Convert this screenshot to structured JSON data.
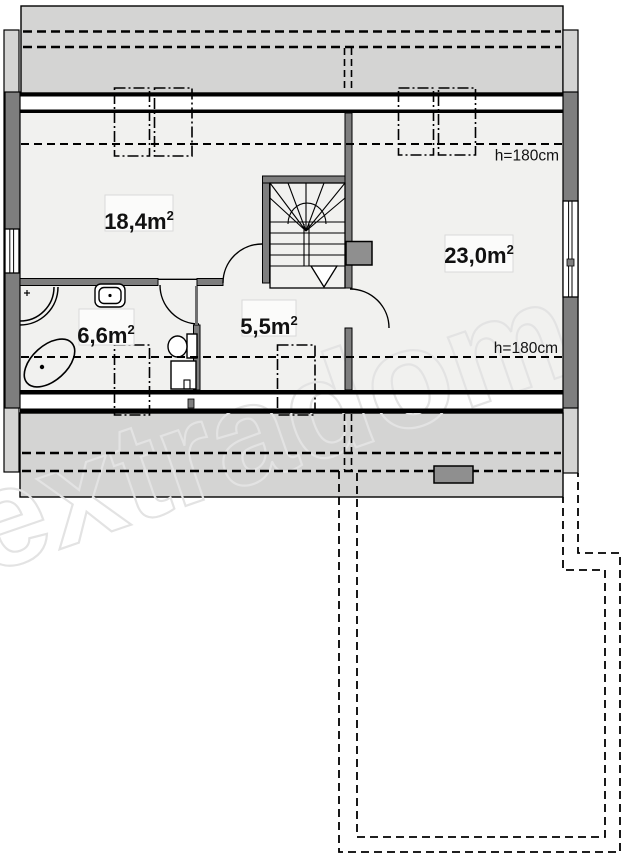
{
  "plan": {
    "watermark": "extradom",
    "rooms": [
      {
        "id": "room-large-left",
        "area_value": "18,4",
        "area_unit": "m",
        "area_sup": "2"
      },
      {
        "id": "room-large-right",
        "area_value": "23,0",
        "area_unit": "m",
        "area_sup": "2"
      },
      {
        "id": "bathroom",
        "area_value": "6,6",
        "area_unit": "m",
        "area_sup": "2"
      },
      {
        "id": "hall",
        "area_value": "5,5",
        "area_unit": "m",
        "area_sup": "2"
      }
    ],
    "annotations": {
      "ceiling_height_top": "h=180cm",
      "ceiling_height_bottom": "h=180cm"
    },
    "colors": {
      "wall": "#7e7e7e",
      "eaves": "#d4d4d3",
      "floor": "#f1f1ef",
      "chimney": "#8f8f8f",
      "line": "#000000",
      "watermark": "#e3e3e3"
    }
  }
}
